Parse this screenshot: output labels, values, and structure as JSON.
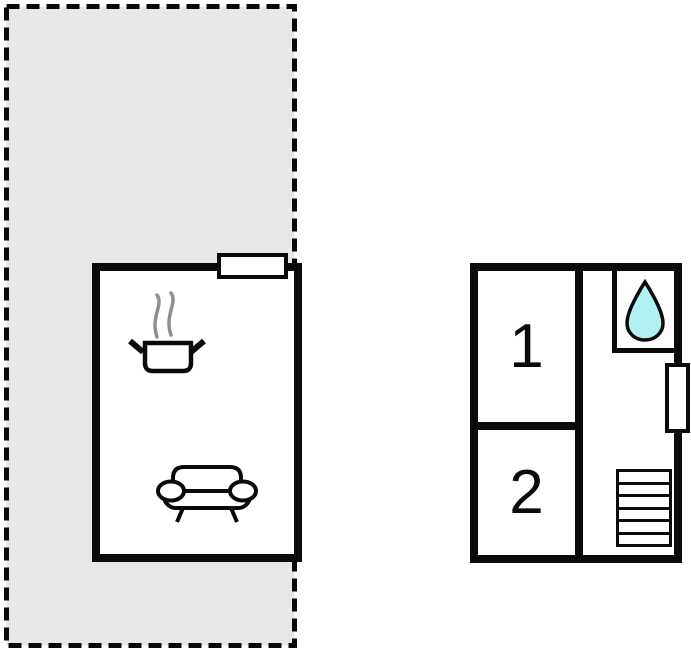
{
  "colors": {
    "terrace_fill": "#e8e8e8",
    "wall": "#0a0a0a",
    "water_drop_fill": "#b3f1f1",
    "steam": "#8f8f8f",
    "background": "#ffffff"
  },
  "floorplan": {
    "rooms": [
      {
        "label": "1"
      },
      {
        "label": "2"
      }
    ],
    "stairs": {
      "steps": 6
    },
    "icons": {
      "kitchen": "steaming-pot-icon",
      "living": "sofa-icon",
      "bathroom": "water-drop-icon",
      "stairs": "stairs-icon",
      "window": "window-marker",
      "door": "door-marker"
    }
  }
}
